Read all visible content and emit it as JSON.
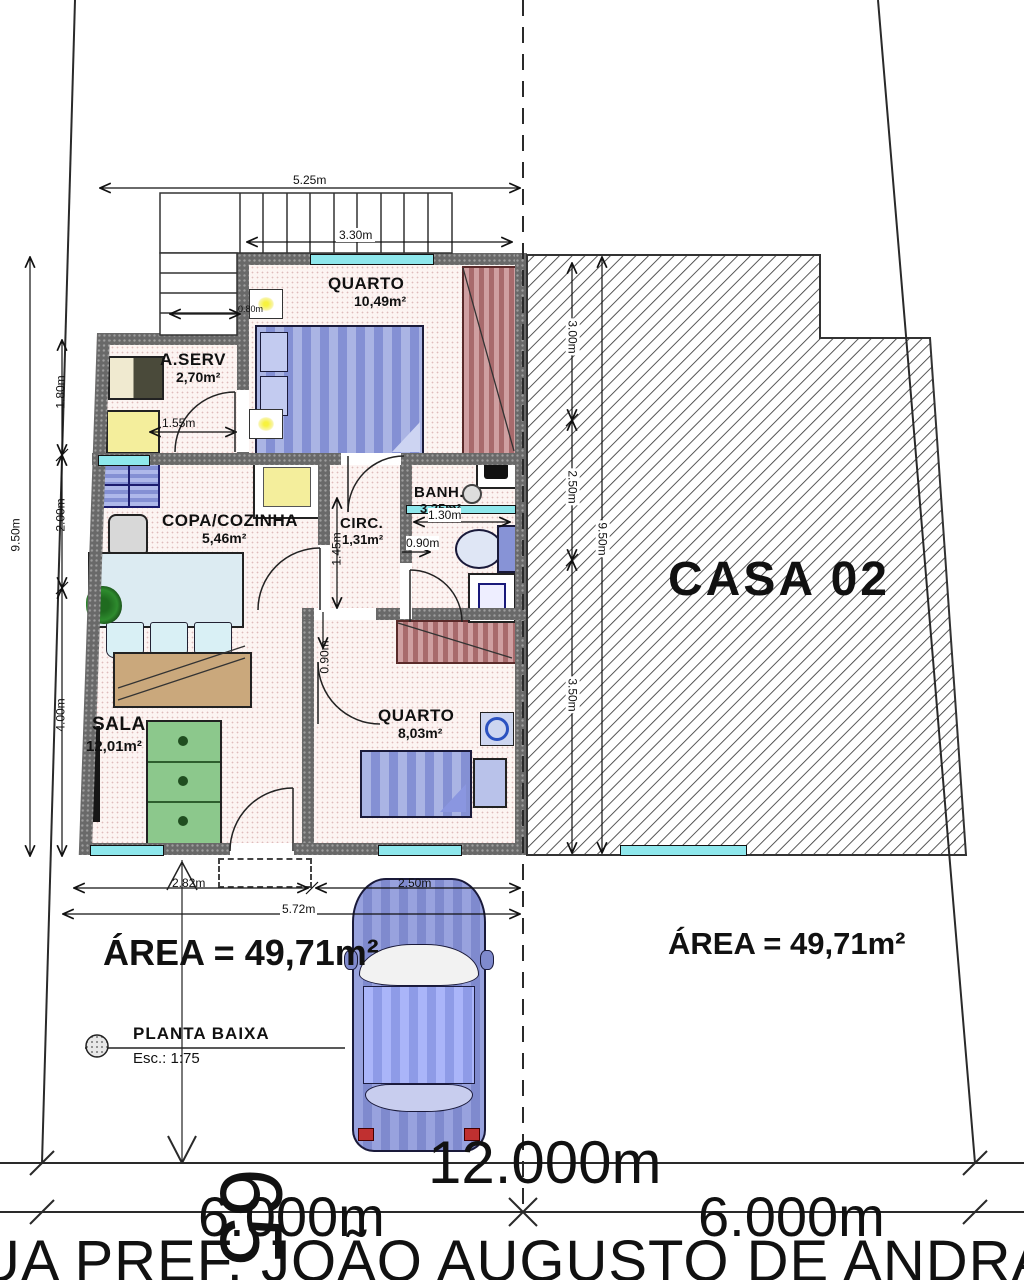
{
  "plan": {
    "rooms": {
      "quarto1": {
        "name": "QUARTO",
        "area": "10,49m²"
      },
      "aserv": {
        "name": "A.SERV",
        "area": "2,70m²"
      },
      "copa": {
        "name": "COPA/COZINHA",
        "area": "5,46m²"
      },
      "circ": {
        "name": "CIRC.",
        "area": "1,31m²"
      },
      "banh": {
        "name": "BANH.",
        "area": "3,25m²"
      },
      "sala": {
        "name": "SALA",
        "area": "12,01m²"
      },
      "quarto2": {
        "name": "QUARTO",
        "area": "8,03m²"
      }
    },
    "area_label": "ÁREA = 49,71m²"
  },
  "neighbor": {
    "label": "CASA 02",
    "area_label": "ÁREA = 49,71m²"
  },
  "dims": {
    "top_width": "5.25m",
    "stair_width": "3.30m",
    "left_total": "9.50m",
    "left_seg1": "1.80m",
    "left_seg2": "2.00m",
    "left_seg3": "4.00m",
    "right_total": "9.50m",
    "right_seg1": "3.00m",
    "right_seg2": "2.50m",
    "right_seg3": "3.50m",
    "aserv_door": "1.55m",
    "stair_run": "0.80m",
    "circ_len": "1.45m",
    "circ_door": "0.90m",
    "banh_width": "1.30m",
    "quarto2_door": "0.90m",
    "front_left": "2.82m",
    "front_car": "2.50m",
    "front_total": "5.72m"
  },
  "lot": {
    "total": "12.000m",
    "left": "6.000m",
    "right": "6.000m",
    "number": "65"
  },
  "caption": {
    "title": "PLANTA BAIXA",
    "scale": "Esc.: 1:75"
  },
  "street": {
    "name": "UA PREF. JOÃO AUGUSTO DE ANDRA"
  },
  "colors": {
    "wall": "#696969",
    "window_glass": "#8ee7ec",
    "hatch_line": "#3a3a3a",
    "furniture_blue": "#8490d4",
    "sofa_green": "#8cc88c",
    "wardrobe_red": "#a86a6c",
    "appliance_yellow": "#f4ee9c",
    "car_blue": "#8a94d8"
  }
}
